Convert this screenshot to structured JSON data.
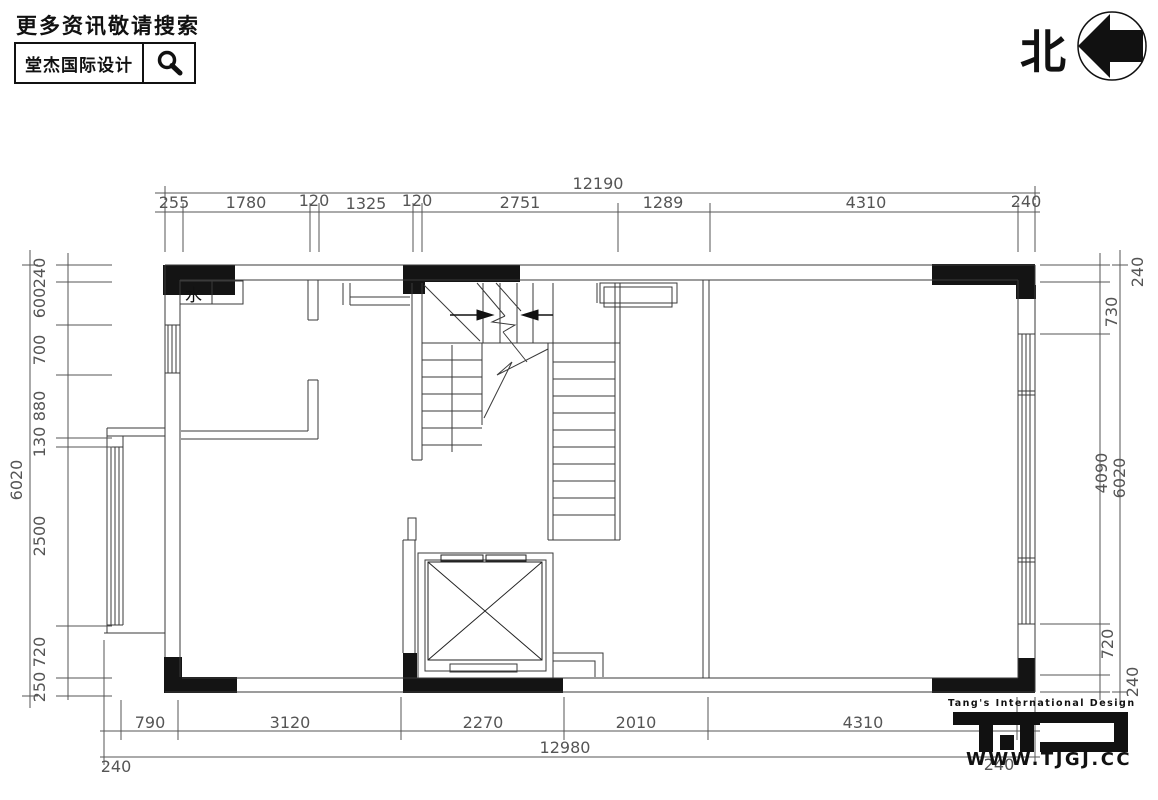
{
  "header": {
    "tagline": "更多资讯敬请搜索",
    "brand": "堂杰国际设计",
    "north_label": "北"
  },
  "plan": {
    "water_label": "水"
  },
  "dims": {
    "top": {
      "overall": "12190",
      "segments": [
        "255",
        "1780",
        "120",
        "1325",
        "120",
        "2751",
        "1289",
        "4310",
        "240"
      ]
    },
    "bottom": {
      "overall": "12980",
      "segments": [
        "790",
        "3120",
        "2270",
        "2010",
        "4310"
      ],
      "left_end": "240",
      "right_end": "240"
    },
    "left": {
      "overall": "6020",
      "segments": [
        "240",
        "600",
        "700",
        "880",
        "130",
        "2500",
        "720",
        "250"
      ]
    },
    "right": {
      "overall": "6020",
      "segments": [
        "240",
        "730",
        "4090",
        "720",
        "240"
      ]
    }
  },
  "footer": {
    "brand_en": "Tang's International Design",
    "website": "WWW.TJGJ.CC"
  },
  "colors": {
    "ink": "#111111",
    "line": "#3a3a3a",
    "dim": "#555555"
  }
}
